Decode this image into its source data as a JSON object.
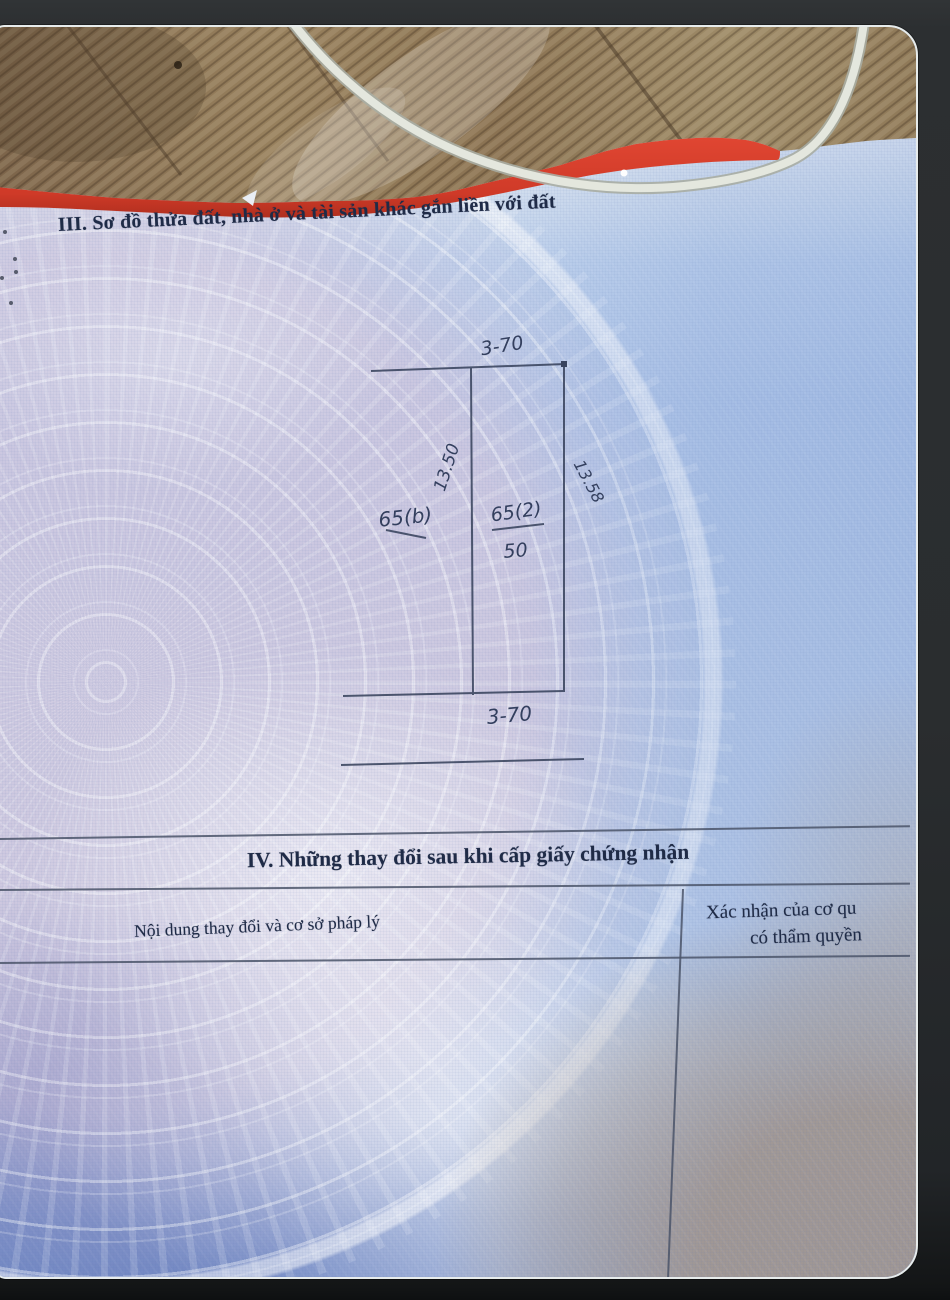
{
  "document": {
    "section_iii": {
      "title": "III. Sơ đồ thửa đất, nhà ở và tài sản khác gắn liền với đất"
    },
    "plot_diagram": {
      "top_width": "3-70",
      "bottom_width": "3-70",
      "left_length": "13.50",
      "right_length": "13.58",
      "adjacent_parcel_label": "65(b)",
      "parcel_number": "65(2)",
      "parcel_area": "50"
    },
    "section_iv": {
      "title": "IV. Những thay đổi sau khi cấp giấy chứng nhận"
    },
    "changes_table": {
      "col_content_header": "Nội dung thay đổi và cơ sở pháp lý",
      "col_confirm_header_line1": "Xác nhận của cơ qu",
      "col_confirm_header_line2": "có thẩm quyền"
    }
  },
  "colors": {
    "backdrop_dark": "#2b2e30",
    "paper_blue": "#b6c9e8",
    "emblem_pink": "#e0c6d8",
    "cover_red": "#d84231",
    "wood_brown": "#8f7553",
    "cable_gray": "#e3e6dd",
    "ink_navy": "#1f2b47",
    "handwriting_ink": "#333f5e"
  }
}
